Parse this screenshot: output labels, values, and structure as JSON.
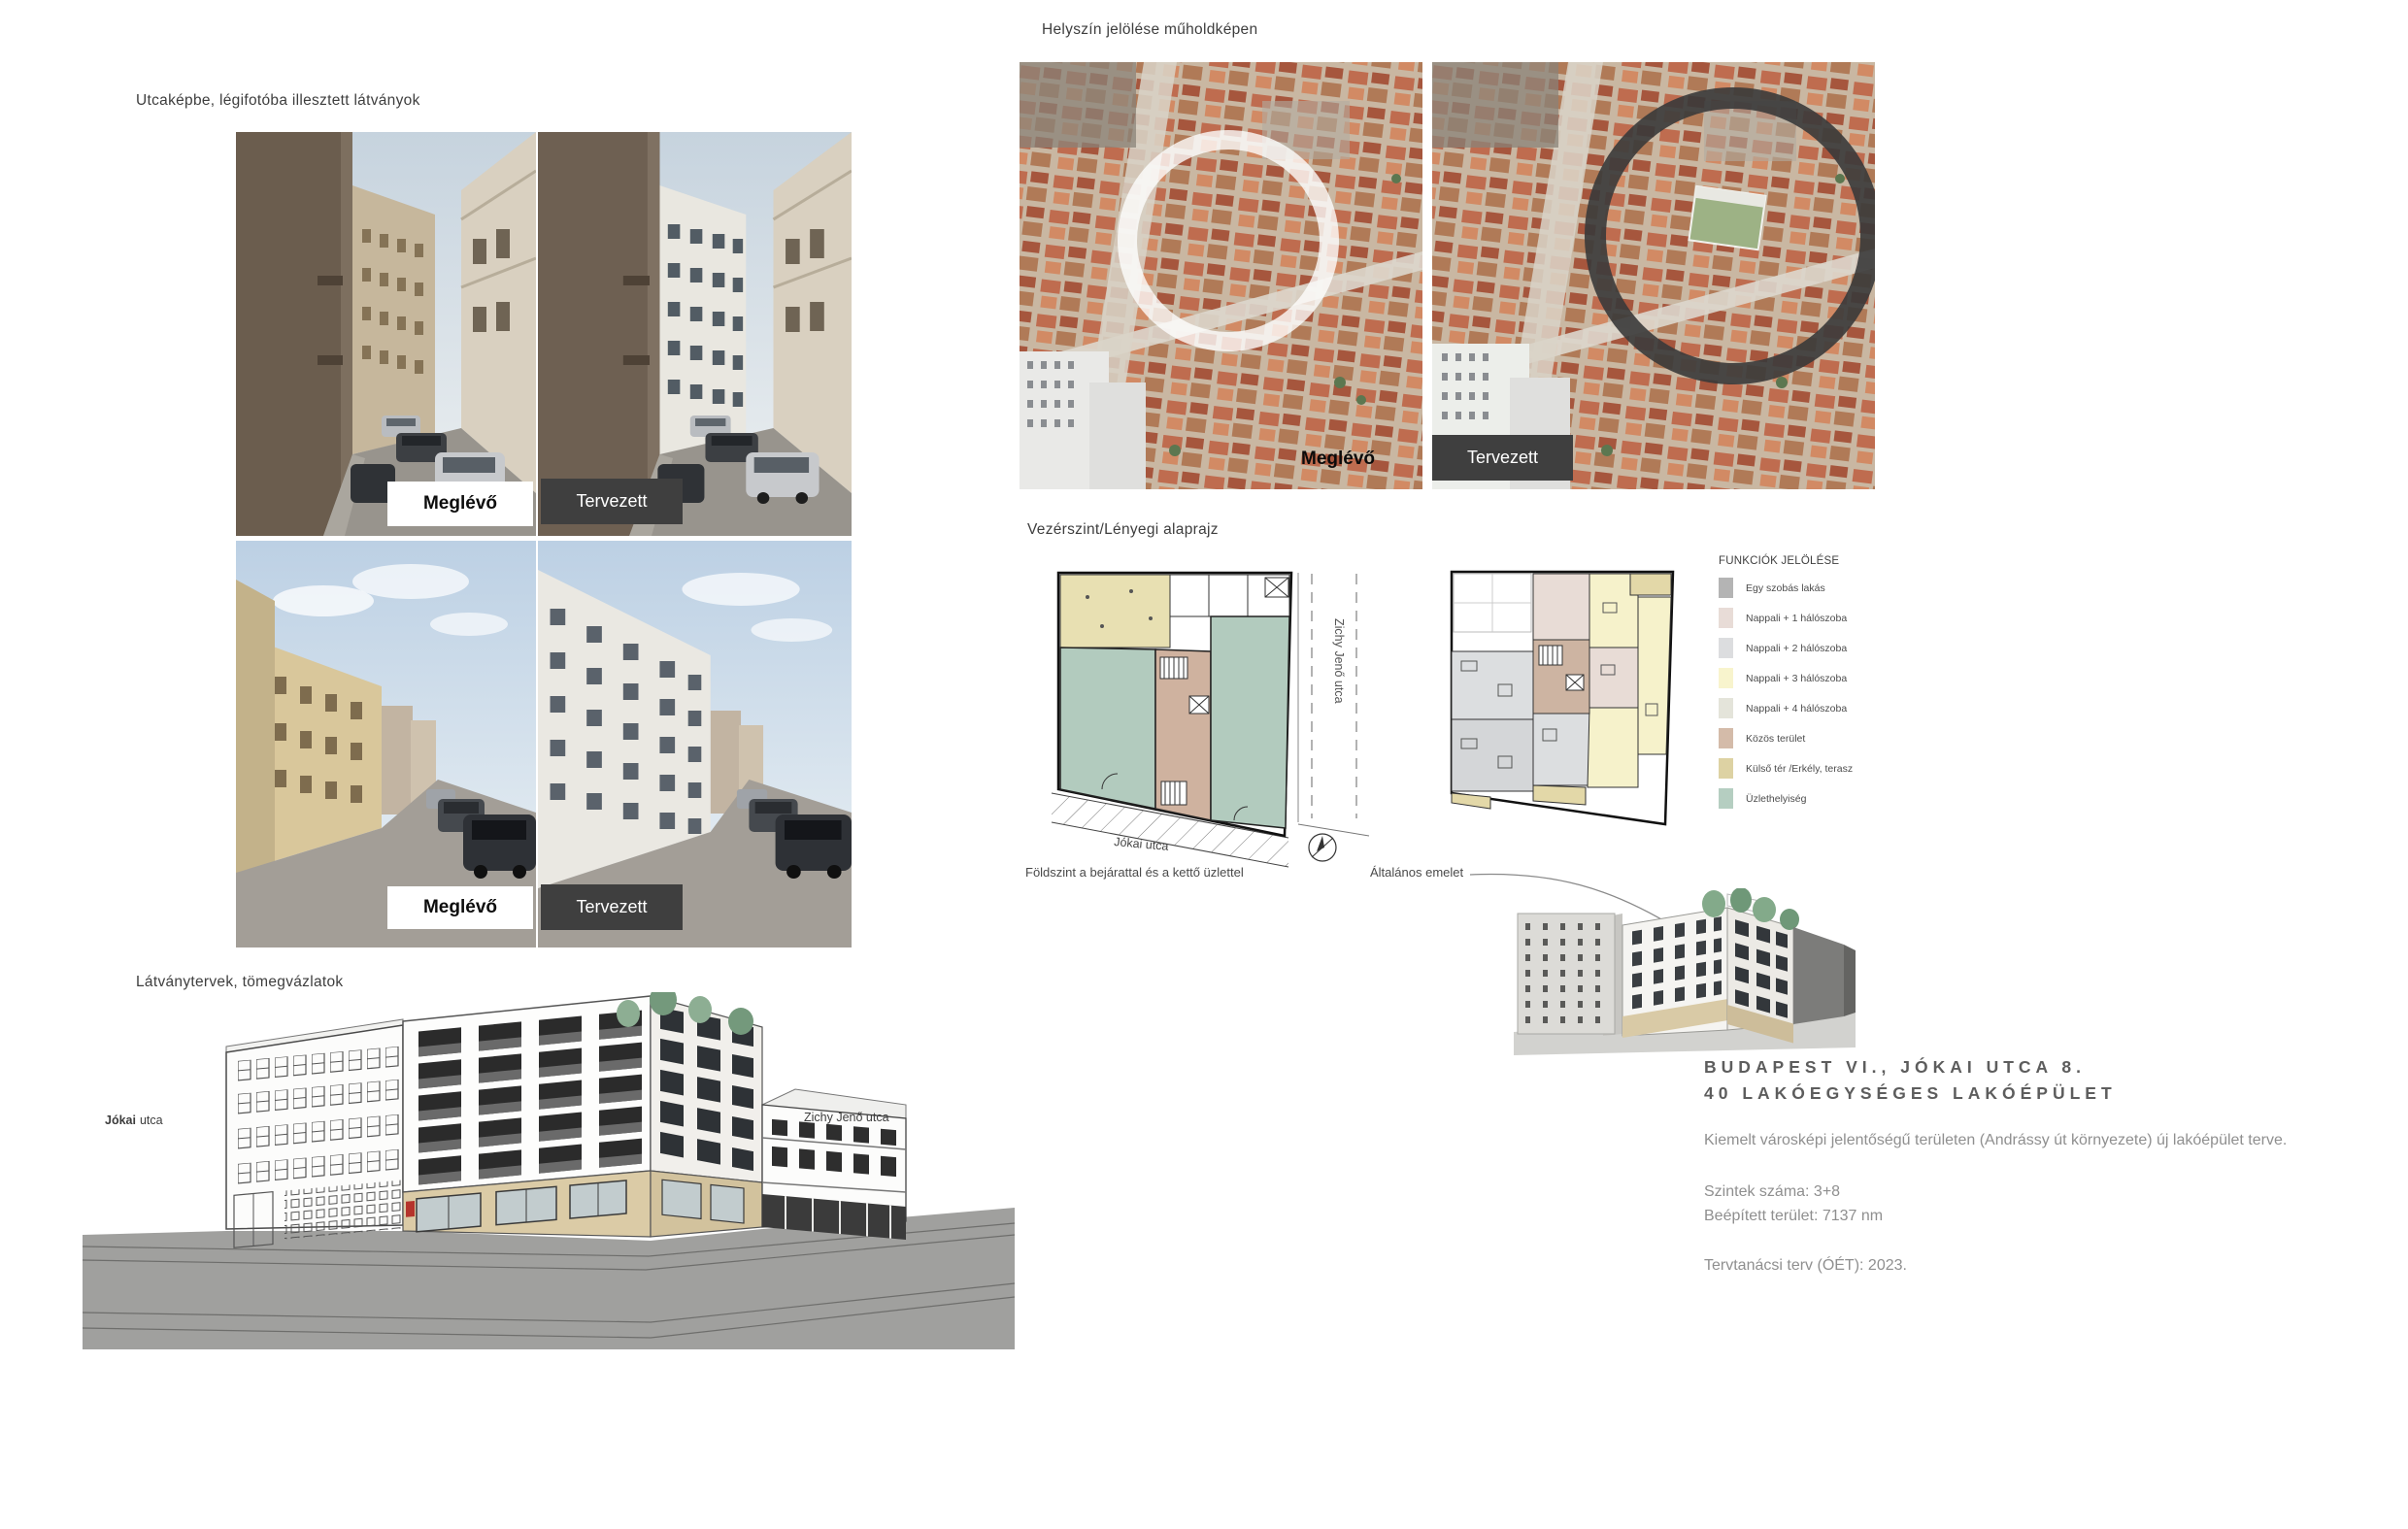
{
  "sections": {
    "street_views": {
      "heading": "Utcaképbe, légifotóba illesztett látványok"
    },
    "satellite": {
      "heading": "Helyszín jelölése műholdképen"
    },
    "plans": {
      "heading": "Vezérszint/Lényegi alaprajz"
    },
    "massing": {
      "heading": "Látványtervek, tömegvázlatok"
    }
  },
  "labels": {
    "existing": "Meglévő",
    "proposed": "Tervezett"
  },
  "plan_captions": {
    "ground_floor": "Földszint a bejárattal és a kettő üzlettel",
    "typical_floor": "Általános emelet"
  },
  "plan_annotations": {
    "zichy_street": "Zichy Jenő utca",
    "jokai_street": "Jókai utca"
  },
  "sketch_labels": {
    "jokai_bold": "Jókai",
    "jokai_rest": "utca",
    "zichy": "Zichy Jenő utca"
  },
  "legend": {
    "title": "FUNKCIÓK JELÖLÉSE",
    "items": [
      {
        "label": "Egy szobás lakás",
        "color": "#b4b4b4"
      },
      {
        "label": "Nappali + 1 hálószoba",
        "color": "#e8dcd7"
      },
      {
        "label": "Nappali + 2 hálószoba",
        "color": "#dcdddf"
      },
      {
        "label": "Nappali + 3 hálószoba",
        "color": "#f8f4cd"
      },
      {
        "label": "Nappali + 4 hálószoba",
        "color": "#e4e4da"
      },
      {
        "label": "Közös terület",
        "color": "#d4bba9"
      },
      {
        "label": "Külső tér /Erkély, terasz",
        "color": "#ddd2a3"
      },
      {
        "label": "Üzlethelyiség",
        "color": "#b5cec1"
      }
    ]
  },
  "project": {
    "title_line1": "BUDAPEST VI., JÓKAI UTCA 8.",
    "title_line2": "40 LAKÓEGYSÉGES LAKÓÉPÜLET",
    "description": "Kiemelt városképi jelentőségű területen (Andrássy út környezete) új lakóépület terve.",
    "levels": "Szintek száma: 3+8",
    "built_area": "Beépített terület: 7137 nm",
    "approval": "Tervtanácsi terv (ÓÉT): 2023."
  }
}
